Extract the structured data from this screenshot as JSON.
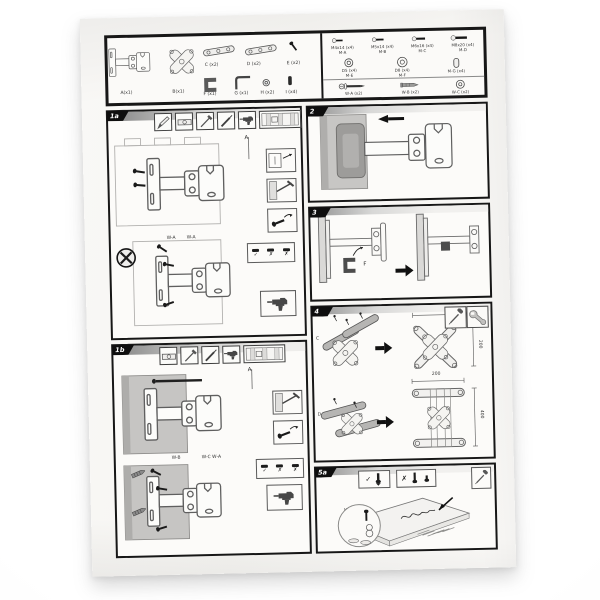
{
  "sheet": {
    "parts": {
      "a": "A(x1)",
      "b": "B(x1)",
      "c": "C (x2)",
      "d": "D (x2)",
      "e": "E (x2)",
      "f": "F (x1)",
      "g": "G (x1)",
      "h": "H (x2)",
      "i": "I (x4)"
    },
    "hardware": {
      "r1": [
        {
          "size": "M4x14 (x4)",
          "code": "M-A"
        },
        {
          "size": "M5x14 (x4)",
          "code": "M-B"
        },
        {
          "size": "M6x16 (x4)",
          "code": "M-C"
        },
        {
          "size": "M8x20 (x4)",
          "code": "M-D"
        }
      ],
      "r2": [
        {
          "size": "D5 (x4)",
          "code": "M-E"
        },
        {
          "size": "D8 (x4)",
          "code": "M-F"
        },
        {
          "size": "M-G (x4)",
          "code": ""
        }
      ],
      "r3": [
        {
          "size": "W-A (x2)"
        },
        {
          "size": "W-B (x2)"
        },
        {
          "size": "W-C (x2)"
        }
      ]
    },
    "sections": {
      "s1a": {
        "tab": "1a",
        "callout": "A",
        "screw1": "W-A",
        "screw2": "W-A",
        "marks": [
          "✓",
          "✗",
          "✗"
        ]
      },
      "s1b": {
        "tab": "1b",
        "callout": "A",
        "screw1": "W-B",
        "screw2": "W-C W-A",
        "marks": [
          "✓",
          "✗",
          "✗"
        ]
      },
      "s2": {
        "tab": "2"
      },
      "s3": {
        "tab": "3",
        "callout": "F"
      },
      "s4": {
        "tab": "4",
        "callout1": "C",
        "callout2": "D",
        "dims": {
          "r1_top": "200",
          "r1_side": "200",
          "r2_top": "200",
          "r2_side": "400"
        }
      },
      "s5a": {
        "tab": "5a",
        "check": "✓",
        "cross": "✗",
        "mag": [
          "M-A",
          "M-B",
          "M-C",
          "M-E",
          "M-F"
        ]
      }
    }
  }
}
